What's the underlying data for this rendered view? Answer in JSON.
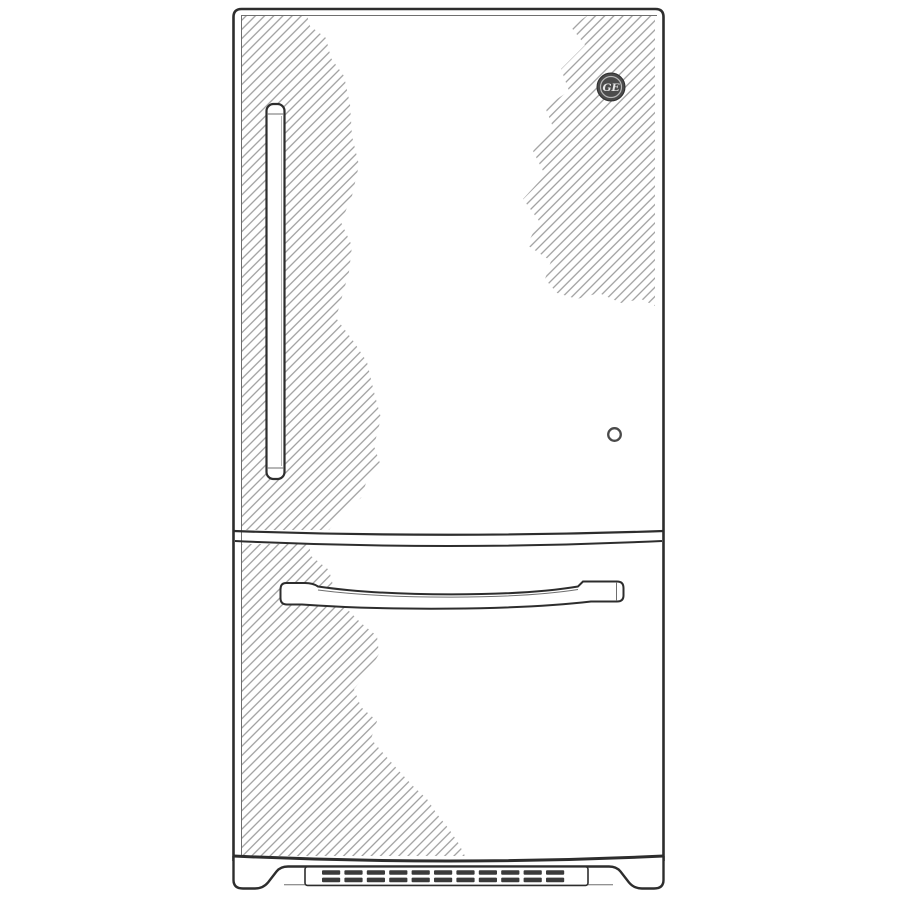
{
  "illustration": {
    "title": "Bottom-freezer refrigerator front-view line drawing",
    "logo_text": "GE",
    "parts": {
      "fridge_door": "refrigerator door",
      "fridge_door_handle": "vertical door handle",
      "freezer_drawer": "freezer drawer",
      "freezer_drawer_handle": "curved drawer handle",
      "status_indicator": "round door indicator",
      "kick_plate": "base kick plate",
      "vent_grille": "vent grille"
    },
    "icons": {
      "logo": "ge-monogram-icon"
    }
  },
  "colors": {
    "outline": "#2d2d2d",
    "line_soft": "#6e6e6e",
    "hatch": "#949494",
    "logo_bg": "#4c4c4c",
    "logo_ring": "#b9b9b9",
    "logo_text": "#e9e9e9",
    "slat": "#3a3a3a",
    "background": "#ffffff"
  },
  "grille": {
    "rows": 2,
    "slats_per_row": 11,
    "slat_width": 18.2,
    "slat_height": 4.6,
    "slat_gap": 4.2,
    "start_x": 322,
    "row_y": [
      870.2,
      877.6
    ]
  }
}
